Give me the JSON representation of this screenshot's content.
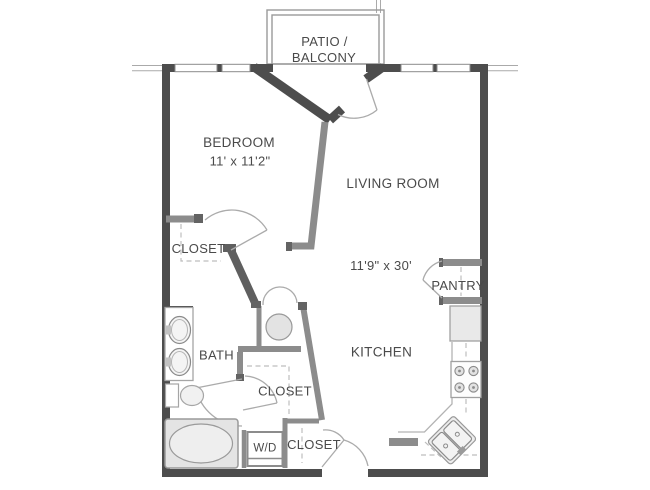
{
  "plan": {
    "rooms": {
      "patio_line1": "PATIO /",
      "patio_line2": "BALCONY",
      "bedroom": "BEDROOM",
      "bedroom_dim": "11' x 11'2\"",
      "living": "LIVING ROOM",
      "living_dim": "11'9\" x 30'",
      "kitchen": "KITCHEN",
      "pantry": "PANTRY",
      "bath": "BATH",
      "closet_left": "CLOSET",
      "closet_middle": "CLOSET",
      "closet_lower": "CLOSET",
      "washer_dryer": "W/D"
    },
    "colors": {
      "exterior_wall": "#4d4d4d",
      "interior_wall": "#8c8c8c",
      "wall_cap": "#636363",
      "door_arc": "#ababab",
      "dashed_line": "#bdbdbd",
      "fixture_outline": "#9a9a9a",
      "fixture_fill": "#e8e8e8",
      "label_text": "#4a4a4a"
    }
  }
}
